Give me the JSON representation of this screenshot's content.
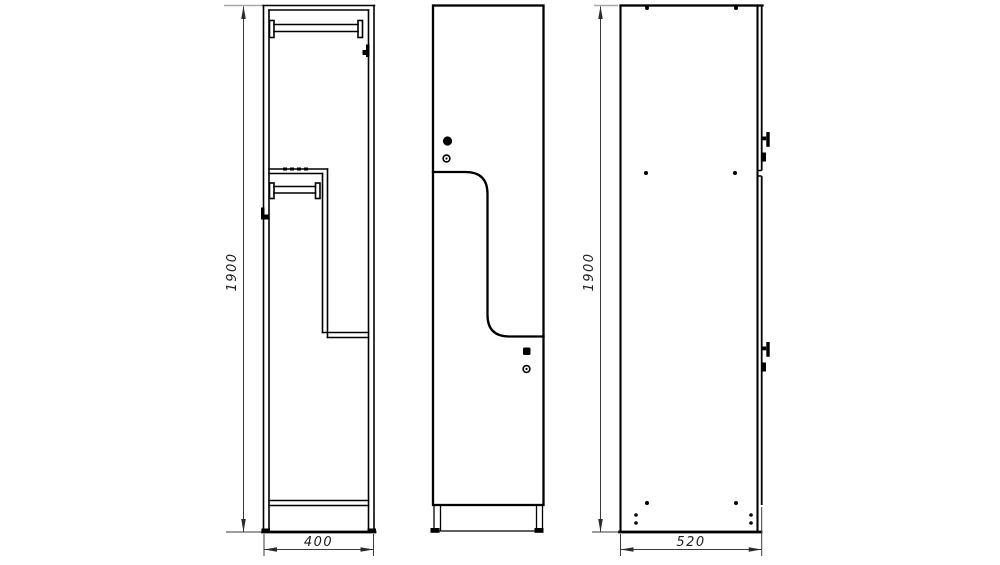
{
  "page": {
    "background": "#ffffff"
  },
  "drawing": {
    "kind": "locker-orthographic-views",
    "colors": {
      "object_line": "#000000",
      "dimension_line": "#3a3a3a",
      "extension_line_gray": "#a8a8a8",
      "background": "#ffffff"
    },
    "dimensions": {
      "front": {
        "height": "1900",
        "width": "400"
      },
      "side": {
        "height": "1900",
        "depth": "520"
      }
    },
    "views": {
      "front_section": {
        "name": "front-section-view",
        "components": [
          "top-panel",
          "side-walls",
          "top-hanger-rod",
          "wall-hook-right",
          "mid-shelf",
          "z-divider",
          "mid-hanger-rod",
          "wall-hook-left",
          "divider-shelf",
          "bottom-shelf",
          "base-feet"
        ]
      },
      "front": {
        "name": "front-door-view",
        "components": [
          "upper-z-door",
          "lower-z-door",
          "door-split-line",
          "lock-upper",
          "keyhole-upper",
          "lock-lower",
          "keyhole-lower",
          "plinth",
          "base-feet"
        ]
      },
      "side": {
        "name": "side-view",
        "components": [
          "side-panel",
          "door-edge",
          "door-joint",
          "hinge-top",
          "latch-top",
          "hinge-bottom",
          "latch-bottom",
          "assembly-screws",
          "foot-screws"
        ]
      }
    }
  }
}
